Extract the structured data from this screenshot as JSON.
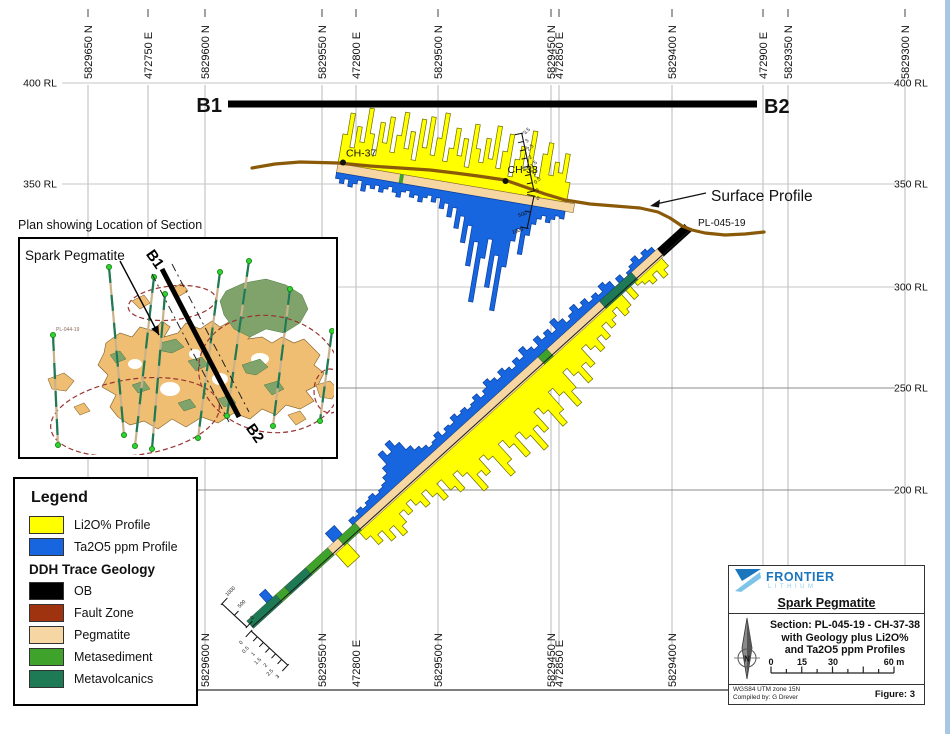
{
  "colors": {
    "li2o": "#FFFF00",
    "ta2o5": "#1766DF",
    "ob": "#000000",
    "fault": "#A0330F",
    "pegmatite": "#F6D7A4",
    "metasediment": "#3FA32B",
    "metavolcanics": "#1E7A55",
    "surface": "#8A5A08",
    "brand": "#1B75BC",
    "brand_light": "#8FCBEA",
    "edge_strip": "#A9C6E2"
  },
  "axes": {
    "top_labels": [
      {
        "t": "5829650 N",
        "x": 88
      },
      {
        "t": "472750 E",
        "x": 148
      },
      {
        "t": "5829600 N",
        "x": 205
      },
      {
        "t": "5829550 N",
        "x": 322
      },
      {
        "t": "472800 E",
        "x": 356
      },
      {
        "t": "5829500 N",
        "x": 438
      },
      {
        "t": "5829450 N",
        "x": 551
      },
      {
        "t": "472850 E",
        "x": 559
      },
      {
        "t": "5829400 N",
        "x": 672
      },
      {
        "t": "472900 E",
        "x": 763
      },
      {
        "t": "5829350 N",
        "x": 788
      },
      {
        "t": "5829300 N",
        "x": 905
      }
    ],
    "bottom_labels": [
      {
        "t": "5829600 N",
        "x": 205
      },
      {
        "t": "5829550 N",
        "x": 322
      },
      {
        "t": "472800 E",
        "x": 356
      },
      {
        "t": "5829500 N",
        "x": 438
      },
      {
        "t": "5829450 N",
        "x": 551
      },
      {
        "t": "472850 E",
        "x": 559
      },
      {
        "t": "5829400 N",
        "x": 672
      }
    ],
    "rl_left": [
      {
        "t": "400 RL",
        "y": 83
      },
      {
        "t": "350 RL",
        "y": 184
      }
    ],
    "rl_right": [
      {
        "t": "400 RL",
        "y": 83
      },
      {
        "t": "350 RL",
        "y": 184
      },
      {
        "t": "300 RL",
        "y": 287
      },
      {
        "t": "250 RL",
        "y": 388
      },
      {
        "t": "200 RL",
        "y": 490
      }
    ],
    "grid_x": [
      88,
      148,
      205,
      322,
      356,
      438,
      551,
      559,
      672,
      763,
      788,
      905
    ],
    "grid_y": [
      {
        "y": 83,
        "dark": false
      },
      {
        "y": 184,
        "dark": false
      },
      {
        "y": 287,
        "dark": false
      },
      {
        "y": 388,
        "dark": true
      },
      {
        "y": 490,
        "dark": true
      }
    ]
  },
  "section_bar": {
    "left_label": "B1",
    "right_label": "B2",
    "x1": 228,
    "x2": 757,
    "y": 100.5,
    "h": 7
  },
  "surface_profile": {
    "label": "Surface Profile",
    "points": [
      [
        252,
        168
      ],
      [
        275,
        164
      ],
      [
        300,
        162
      ],
      [
        338,
        163
      ],
      [
        370,
        166
      ],
      [
        400,
        168
      ],
      [
        430,
        170
      ],
      [
        455,
        173
      ],
      [
        478,
        176
      ],
      [
        505,
        180
      ],
      [
        525,
        187
      ],
      [
        545,
        194
      ],
      [
        565,
        200
      ],
      [
        590,
        204
      ],
      [
        615,
        206
      ],
      [
        640,
        208
      ],
      [
        658,
        212
      ],
      [
        670,
        218
      ],
      [
        682,
        226
      ],
      [
        692,
        230
      ],
      [
        705,
        233
      ],
      [
        725,
        235
      ],
      [
        745,
        234
      ],
      [
        764,
        232
      ]
    ]
  },
  "drillholes": {
    "ch37": {
      "label": "CH-37",
      "x": 343,
      "y": 162.5
    },
    "ch38": {
      "label": "CH-38",
      "x": 505.5,
      "y": 181
    },
    "pl": {
      "label": "PL-045-19",
      "x": 698,
      "y": 226
    }
  },
  "channel": {
    "x1": 338,
    "y1": 163.5,
    "x2": 570,
    "y2": 203,
    "bar_w": 4.46,
    "band_w": 9,
    "yellow": [
      30,
      52,
      18,
      40,
      25,
      60,
      35,
      14,
      48,
      28,
      55,
      20,
      38,
      62,
      26,
      44,
      16,
      58,
      30,
      62,
      24,
      42,
      68,
      20,
      34,
      55,
      28,
      46,
      18,
      62,
      38,
      25,
      50,
      30,
      64,
      22,
      40,
      58,
      16,
      34,
      48,
      26,
      65,
      30,
      20,
      44,
      56,
      24,
      38,
      28,
      48,
      20
    ],
    "blue": [
      6,
      10,
      5,
      12,
      8,
      4,
      14,
      7,
      10,
      6,
      12,
      8,
      5,
      10,
      14,
      8,
      6,
      12,
      9,
      15,
      10,
      7,
      13,
      8,
      18,
      12,
      25,
      15,
      35,
      22,
      48,
      30,
      70,
      45,
      105,
      60,
      40,
      88,
      55,
      110,
      65,
      38,
      25,
      50,
      30,
      18,
      12,
      8,
      14,
      10,
      6,
      8
    ]
  },
  "hole": {
    "x1": 690,
    "y1": 230,
    "x2": 252,
    "y2": 627,
    "bar_w": 6,
    "d0": 40,
    "segments": [
      {
        "d0": 0,
        "d1": 37,
        "key": "ob"
      },
      {
        "d0": 37,
        "d1": 72,
        "key": "pegmatite"
      },
      {
        "d0": 72,
        "d1": 115,
        "key": "metavolcanics"
      },
      {
        "d0": 115,
        "d1": 186,
        "key": "pegmatite"
      },
      {
        "d0": 186,
        "d1": 198,
        "key": "metasediment"
      },
      {
        "d0": 198,
        "d1": 445,
        "key": "pegmatite"
      },
      {
        "d0": 445,
        "d1": 468,
        "key": "metasediment"
      },
      {
        "d0": 468,
        "d1": 482,
        "key": "pegmatite"
      },
      {
        "d0": 482,
        "d1": 512,
        "key": "metasediment"
      },
      {
        "d0": 512,
        "d1": 540,
        "key": "metavolcanics"
      },
      {
        "d0": 540,
        "d1": 552,
        "key": "metasediment"
      },
      {
        "d0": 552,
        "d1": 591,
        "key": "metavolcanics"
      }
    ],
    "yellow": [
      12,
      18,
      8,
      15,
      10,
      6,
      0,
      14,
      0,
      16,
      20,
      8,
      14,
      20,
      12,
      25,
      18,
      30,
      22,
      15,
      35,
      28,
      45,
      30,
      20,
      40,
      55,
      35,
      25,
      48,
      60,
      38,
      30,
      52,
      42,
      65,
      45,
      35,
      58,
      40,
      30,
      50,
      62,
      35,
      28,
      45,
      38,
      55,
      30,
      22,
      40,
      32,
      18,
      35,
      25,
      15,
      28,
      20,
      12,
      22,
      15,
      26,
      34,
      20,
      30,
      16,
      24,
      12
    ],
    "blue": [
      5,
      8,
      4,
      10,
      6,
      3,
      0,
      6,
      0,
      8,
      12,
      5,
      9,
      6,
      12,
      8,
      15,
      10,
      6,
      12,
      18,
      8,
      14,
      10,
      16,
      8,
      12,
      18,
      10,
      14,
      8,
      12,
      16,
      10,
      14,
      18,
      12,
      8,
      14,
      10,
      8,
      12,
      10,
      14,
      8,
      10,
      6,
      12,
      8,
      6,
      10,
      14,
      20,
      30,
      38,
      28,
      35,
      22,
      15,
      10,
      8,
      6,
      10,
      8,
      5,
      8,
      4,
      6
    ],
    "extra_yellow": [
      {
        "d": 464,
        "w": 16,
        "h": 20
      }
    ],
    "extra_blue": [
      {
        "d": 462,
        "w": 12,
        "h": 12
      },
      {
        "d": 556,
        "w": 8,
        "h": 11
      }
    ]
  },
  "rulers": {
    "ch": {
      "pct": [
        "3.5",
        "3",
        "2.5",
        "2",
        "1.5",
        "1",
        "0.5",
        "0"
      ],
      "ppm": [
        "0",
        "500",
        "1000"
      ]
    },
    "eoh": {
      "ppm": [
        "0",
        "500",
        "1000"
      ],
      "pct": [
        "0",
        "0.5",
        "1",
        "1.5",
        "2",
        "2.5",
        "3"
      ]
    }
  },
  "inset": {
    "title": "Plan showing Location of Section",
    "map_label": "Spark Pegmatite",
    "b1": "B1",
    "b2": "B2",
    "hole_label": "PL-044-19"
  },
  "legend": {
    "title": "Legend",
    "subhead": "DDH Trace Geology",
    "items_top": [
      {
        "label": "Li2O% Profile",
        "color_key": "li2o"
      },
      {
        "label": "Ta2O5 ppm Profile",
        "color_key": "ta2o5"
      }
    ],
    "items_geo": [
      {
        "label": "OB",
        "color_key": "ob"
      },
      {
        "label": "Fault Zone",
        "color_key": "fault"
      },
      {
        "label": "Pegmatite",
        "color_key": "pegmatite"
      },
      {
        "label": "Metasediment",
        "color_key": "metasediment"
      },
      {
        "label": "Metavolcanics",
        "color_key": "metavolcanics"
      }
    ]
  },
  "titleblock": {
    "brand": "FRONTIER",
    "brand_sub": "LITHIUM",
    "project": "Spark Pegmatite",
    "line1": "Section: PL-045-19 - CH-37-38",
    "line2": "with Geology plus Li2O%",
    "line3": "and Ta2O5 ppm Profiles",
    "north": "N",
    "scale_labels": [
      "0",
      "15",
      "30",
      "60 m"
    ],
    "datum": "WGS84 UTM zone 15N",
    "compiled": "Compiled by: G Drever",
    "figure": "Figure: 3"
  }
}
